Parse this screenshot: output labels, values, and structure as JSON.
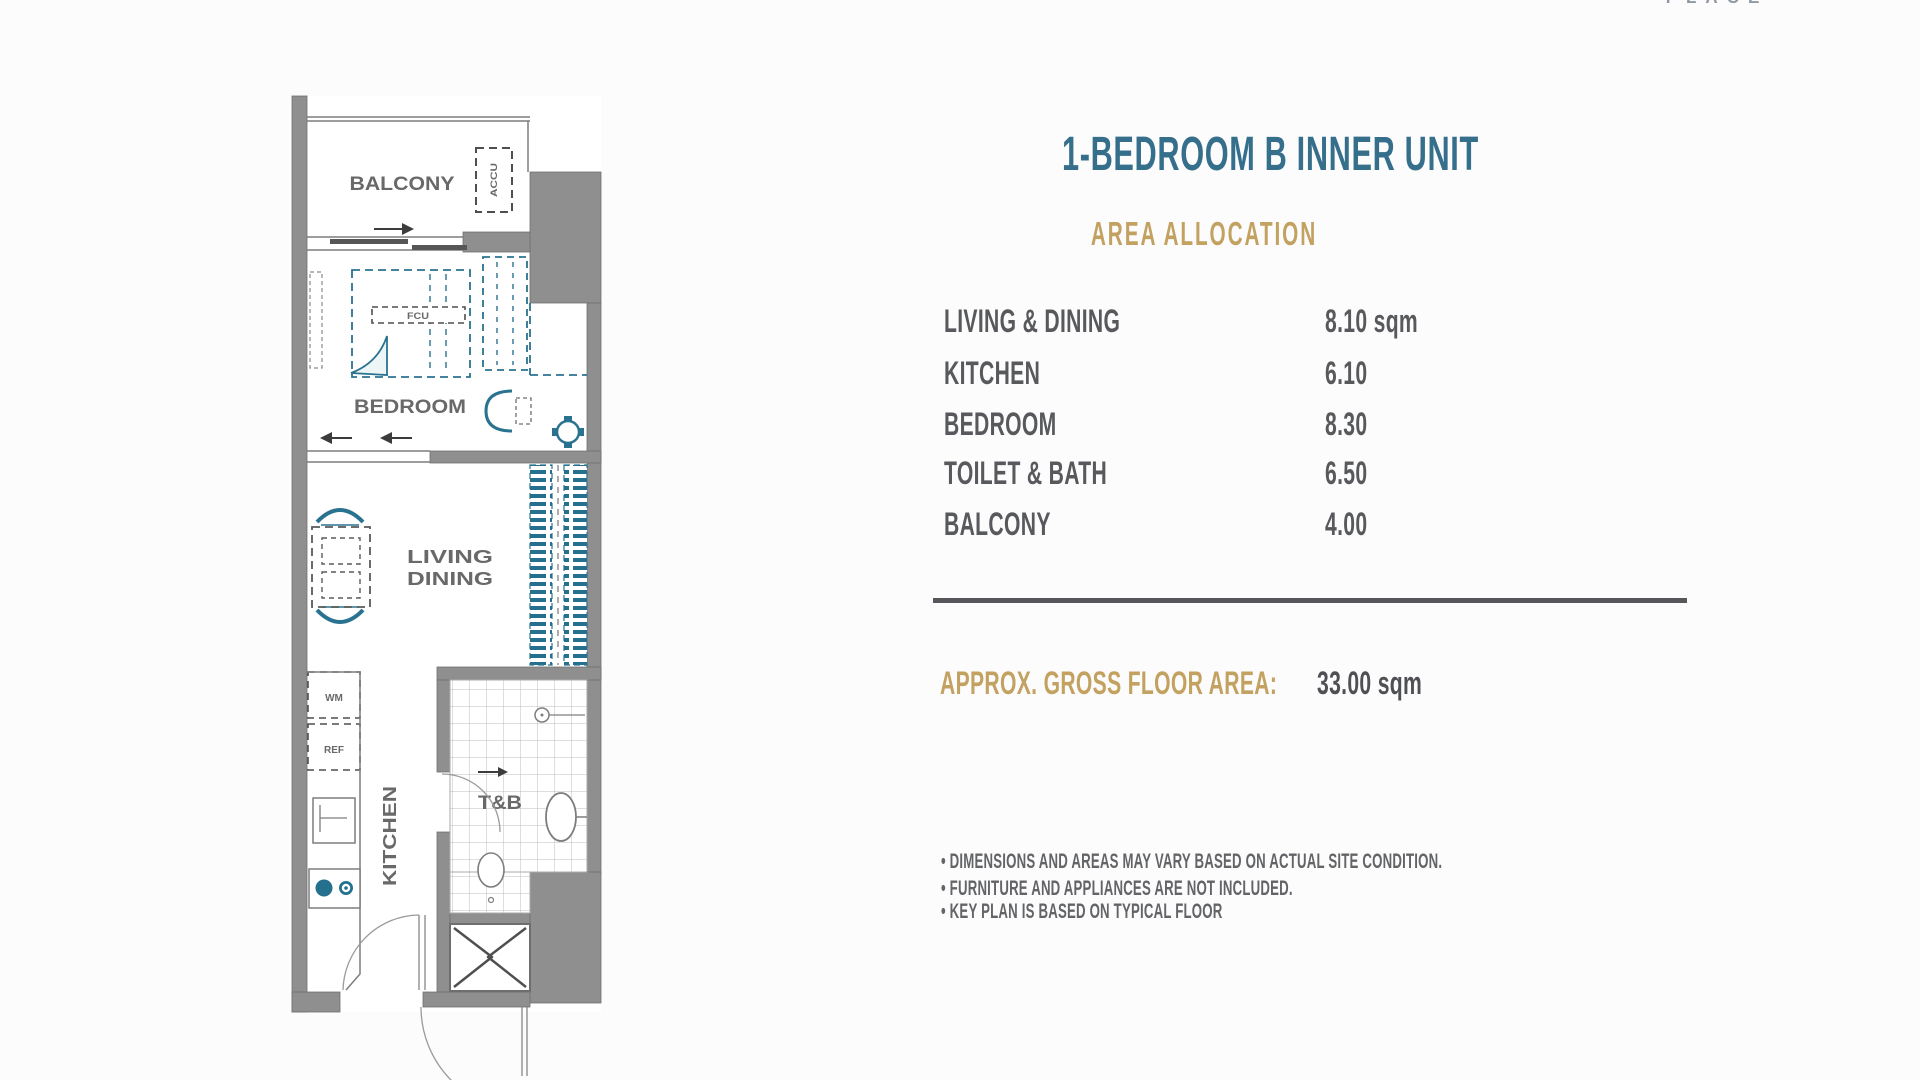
{
  "logo": {
    "text": "PLACE"
  },
  "panel": {
    "title": "1-BEDROOM B INNER UNIT",
    "subtitle": "AREA ALLOCATION",
    "rows": [
      {
        "label": "LIVING & DINING",
        "value": "8.10 sqm"
      },
      {
        "label": "KITCHEN",
        "value": "6.10"
      },
      {
        "label": "BEDROOM",
        "value": "8.30"
      },
      {
        "label": "TOILET & BATH",
        "value": "6.50"
      },
      {
        "label": "BALCONY",
        "value": "4.00"
      }
    ],
    "total": {
      "label": "APPROX. GROSS FLOOR AREA:",
      "value": "33.00 sqm"
    },
    "notes": [
      "• DIMENSIONS AND AREAS MAY VARY BASED ON ACTUAL SITE CONDITION.",
      "• FURNITURE AND APPLIANCES ARE NOT INCLUDED.",
      "• KEY PLAN IS BASED ON TYPICAL FLOOR"
    ]
  },
  "floorplan": {
    "rooms": {
      "balcony": "BALCONY",
      "bedroom": "BEDROOM",
      "living_line1": "LIVING",
      "living_line2": "DINING",
      "kitchen": "KITCHEN",
      "toilet_bath": "T&B"
    },
    "fixtures": {
      "accu": "ACCU",
      "fcu": "FCU",
      "washing_machine": "WM",
      "refrigerator": "REF"
    }
  },
  "colors": {
    "title_teal": "#366f8c",
    "accent_gold": "#c3a160",
    "text_dark": "#58595c",
    "divider": "#56575b",
    "wall_gray": "#8f8f8f",
    "furniture_teal": "#2a7390"
  }
}
